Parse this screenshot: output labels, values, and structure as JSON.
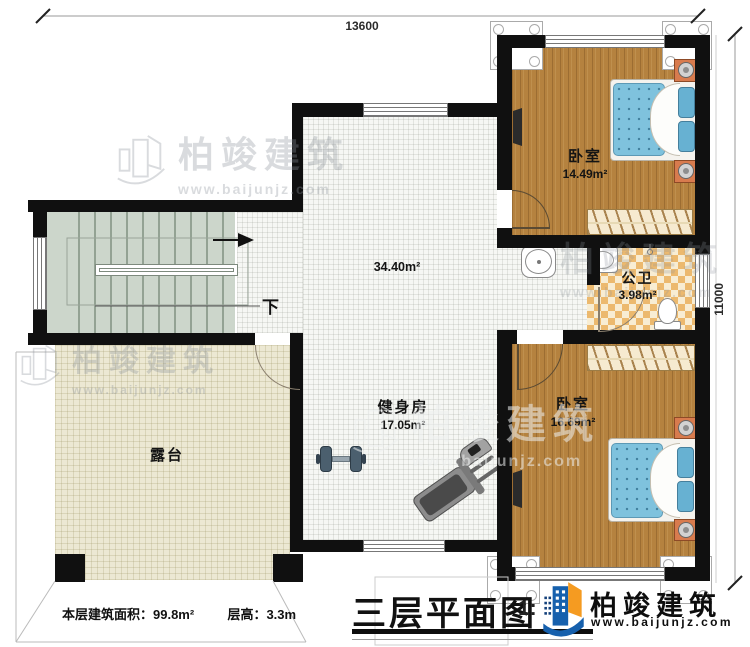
{
  "meta": {
    "plan_title": "三层平面图",
    "scale_label": "1:",
    "floor_area_note": "本层建筑面积：99.8m²",
    "floor_height_note": "层高：3.3m"
  },
  "dimensions": {
    "top": "13600",
    "right": "11000"
  },
  "rooms": [
    {
      "id": "bedroom-1",
      "name": "卧室",
      "area": "14.49m²"
    },
    {
      "id": "bathroom",
      "name": "公卫",
      "area": "3.98m²"
    },
    {
      "id": "bedroom-2",
      "name": "卧室",
      "area": "16.69m²"
    },
    {
      "id": "gym",
      "name": "健身房",
      "area": "17.05m²"
    },
    {
      "id": "hall",
      "name": "",
      "area": "34.40m²"
    },
    {
      "id": "terrace",
      "name": "露台",
      "area": ""
    }
  ],
  "stairs": {
    "down_label": "下"
  },
  "brand": {
    "name": "柏竣建筑",
    "website": "www.baijunjz.com"
  },
  "watermark": {
    "name": "柏竣建筑",
    "website": "www.baijunjz.com"
  },
  "colors": {
    "wall": "#101010",
    "wood_floor": "#b5823f",
    "mattress_blue": "#7fc2dd",
    "checker_tile": "#ecb96e",
    "terrace_floor": "#ece8d3",
    "stair_floor": "#ccd6cb",
    "logo_blue": "#1660ad",
    "logo_orange": "#f59b21"
  }
}
